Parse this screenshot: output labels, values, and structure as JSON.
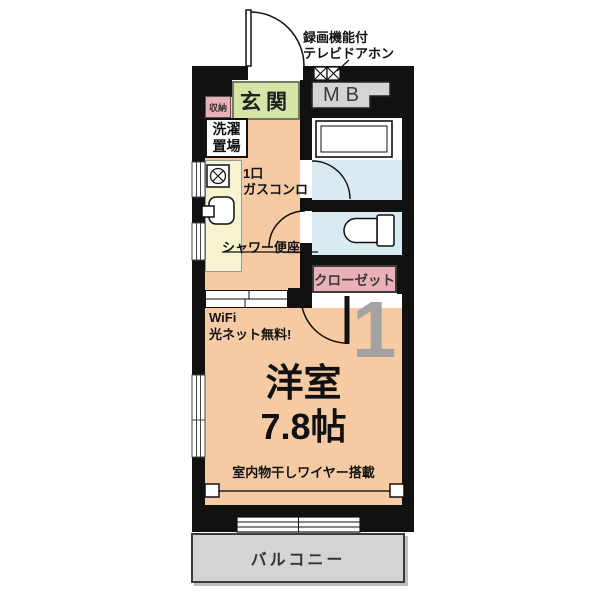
{
  "plan": {
    "labels": {
      "door_phone_line1": "録画機能付",
      "door_phone_line2": "テレビドアホン",
      "entrance": "玄関",
      "meter_box": "MB",
      "storage": "収納",
      "laundry_line1": "洗濯",
      "laundry_line2": "置場",
      "stove_line1": "1口",
      "stove_line2": "ガスコンロ",
      "shower_toilet": "シャワー便座",
      "closet": "クローゼット",
      "wifi_line1": "WiFi",
      "wifi_line2": "光ネット無料!",
      "unit_number": "1",
      "room_name": "洋室",
      "room_size": "7.8帖",
      "laundry_wire": "室内物干しワイヤー搭載",
      "balcony": "バルコニー"
    },
    "colors": {
      "wall": "#111111",
      "room-orange": "#f6cba4",
      "entrance-green": "#d5e5a6",
      "pink": "#e9b0b7",
      "bath-blue": "#d9eaf0",
      "kitchen-yellow": "#f6f3cf",
      "gray-fill": "#d4d4d4",
      "unit-gray": "#a3a3a3"
    }
  }
}
